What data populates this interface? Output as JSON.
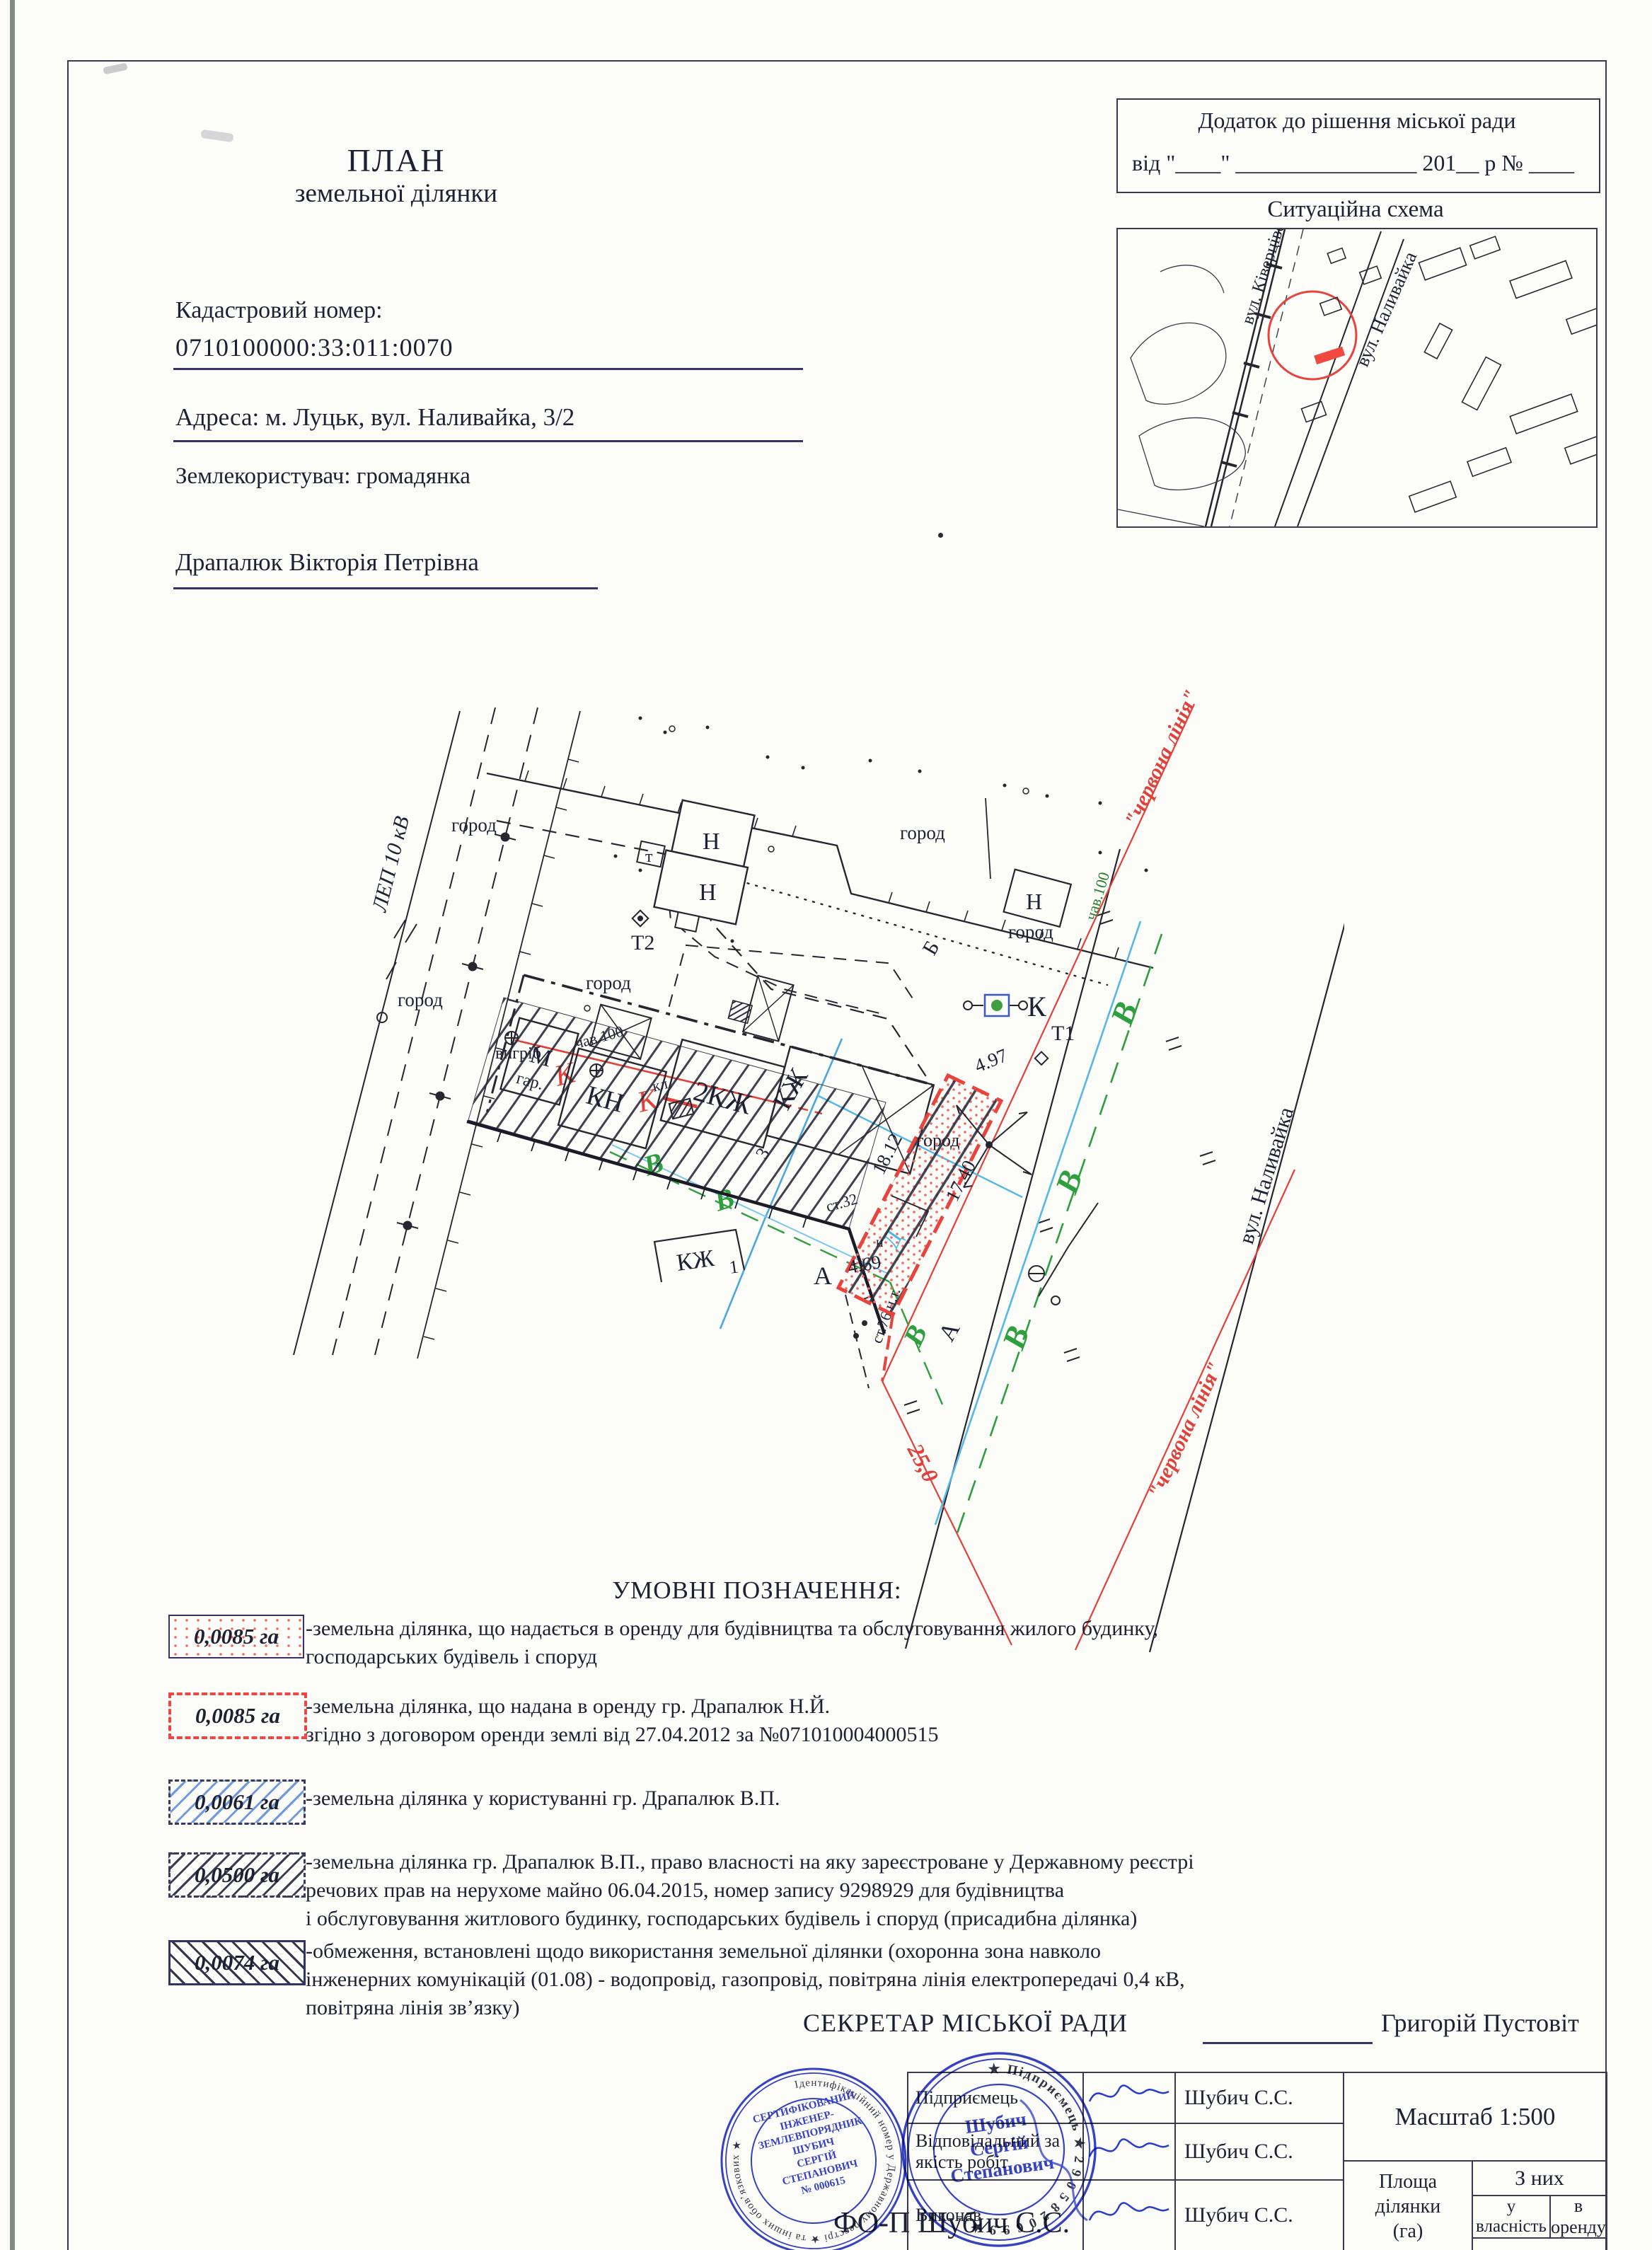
{
  "header": {
    "title_line1": "ПЛАН",
    "title_line2": "земельної ділянки",
    "cadastral_label": "Кадастровий номер:",
    "cadastral_number": "0710100000:33:011:0070",
    "address_line": "Адреса: м. Луцьк, вул. Наливайка, 3/2",
    "user_line": "Землекористувач: громадянка",
    "user_name": "Драпалюк Вікторія Петрівна",
    "annex_line1": "Додаток до рішення міської ради",
    "annex_line2": "від \"____\" ________________ 201__  р № ____"
  },
  "situation": {
    "title": "Ситуаційна схема",
    "street_kivertsivska": "вул. Ківерцівська",
    "street_nalyvaika": "вул. Наливайка"
  },
  "plan": {
    "lep": "ЛЕП 10 кВ",
    "gorod": "город",
    "n": "Н",
    "t": "т",
    "t2": "Т2",
    "t1": "Т1",
    "k": "К",
    "kl": "кл.",
    "vygrib": "вигріб",
    "chav100": "чав.100",
    "st32": "ст.32",
    "st76": "ст.76 н.т.",
    "kzh": "КЖ",
    "kzh2": "2КЖ",
    "kn": "КН",
    "m": "М",
    "gar": "гар.",
    "v": "В",
    "b": "Б",
    "d_letter": "Д",
    "a": "А",
    "street": "вул. Наливайка",
    "red_line": "\"червона лінія\"",
    "d497": "4.97",
    "d1812": "18.12",
    "d1740": "17.40",
    "d469": "4.69",
    "d250": "25,0",
    "n_small": "н",
    "one": "1",
    "three": "3"
  },
  "legend": {
    "title": "УМОВНІ ПОЗНАЧЕННЯ:",
    "items": [
      {
        "area": "0,0085 га",
        "text": "-земельна ділянка, що надається в оренду для будівництва та обслуговування жилого будинку,\n господарських будівель і споруд"
      },
      {
        "area": "0,0085 га",
        "text": "-земельна ділянка, що надана в оренду гр. Драпалюк Н.Й.\nзгідно з договором оренди землі від 27.04.2012 за №071010004000515"
      },
      {
        "area": "0,0061 га",
        "text": "-земельна ділянка у користуванні гр. Драпалюк В.П."
      },
      {
        "area": "0,0500 га",
        "text": "-земельна ділянка гр. Драпалюк В.П., право власності на яку зареєстроване у Державному реєстрі\nречових прав на нерухоме майно 06.04.2015, номер запису 9298929  для будівництва\nі обслуговування житлового будинку, господарських будівель і споруд (присадибна ділянка)"
      },
      {
        "area": "0,0074 га",
        "text": "-обмеження, встановлені щодо використання земельної ділянки (охоронна зона навколо\n інженерних комунікацій (01.08) - водопровід, газопровід, повітряна лінія електропередачі 0,4 кВ,\nповітряна лінія зв’язку)"
      }
    ]
  },
  "footer": {
    "secretary_label": "СЕКРЕТАР МІСЬКОЇ РАДИ",
    "secretary_name": "Григорій Пустовіт",
    "rows": [
      {
        "role": "Підприємець",
        "name": "Шубич С.С."
      },
      {
        "role": "Відповідальний за\nякість робіт",
        "name": "Шубич С.С."
      },
      {
        "role": "Виконав",
        "name": "Шубич С.С."
      }
    ],
    "scale_label": "Масштаб 1:500",
    "area_col": "Площа\nділянки\n(га)",
    "of_them": "З них",
    "ownership": "у власність",
    "lease": "в оренду",
    "fop": "ФО-П Шубич С.С."
  },
  "stamps": {
    "engineer_ring": "Ідентифікаційний номер у Державному реєстрі ★ та інших обов’язкових ★",
    "engineer_center": "СЕРТИФІКОВАНИЙ\nІНЖЕНЕР-\nЗЕМЛЕВПОРЯДНИК\nШУБИЧ\nСЕРГІЙ\nСТЕПАНОВИЧ\n№ 000615",
    "entrepreneur_ring": "★ Підприємець ★  2 9 0 5 8 2 0 6 9 9  ★",
    "entrepreneur_center": "Шубич\nСергій\nСтепанович"
  },
  "colors": {
    "red_line": "#e0413a",
    "legend_red": "#ef4545",
    "water_blue": "#55b8e8",
    "utility_green": "#2f9e3f",
    "stamp_blue": "#2633c0",
    "ink": "#1e2133"
  }
}
